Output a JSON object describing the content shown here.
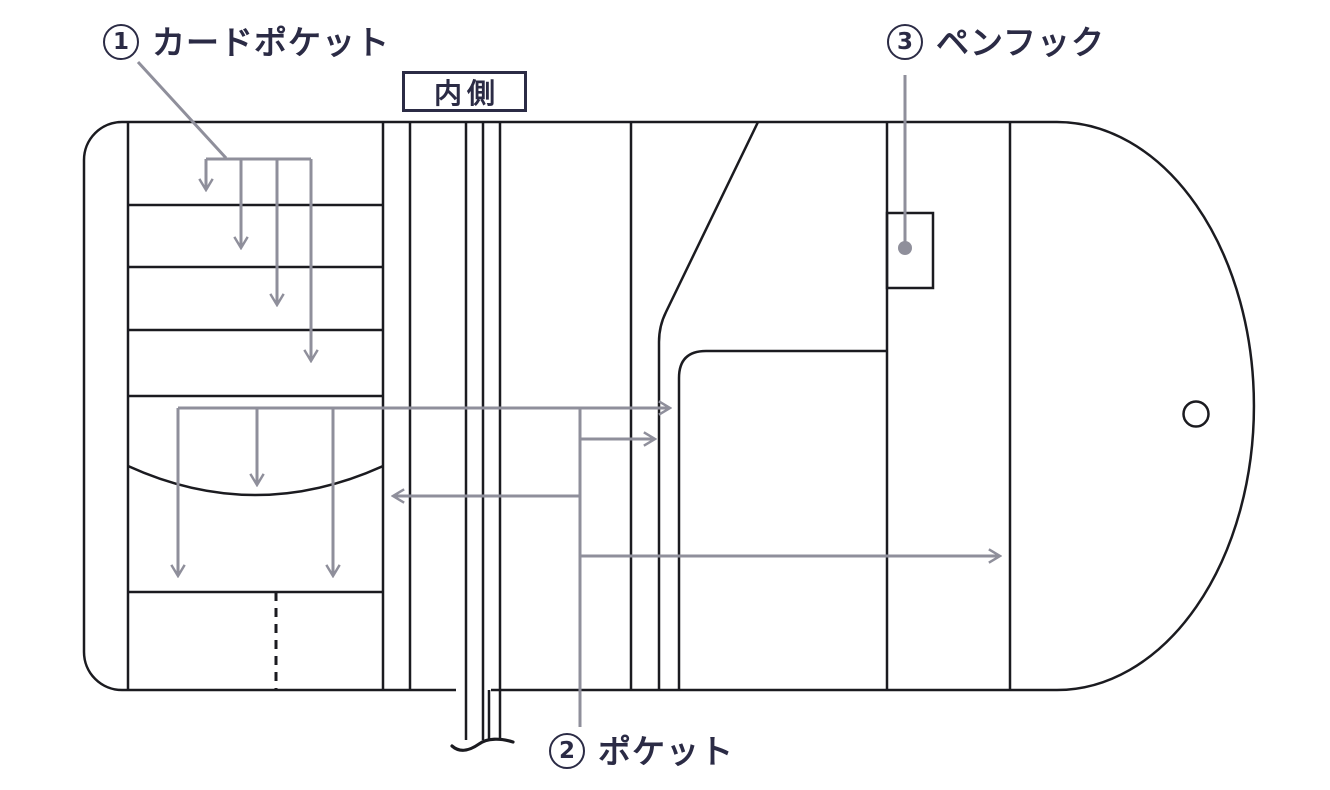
{
  "colors": {
    "background": "#ffffff",
    "line_ink": "#1b1b20",
    "annotation_gray": "#8f8f9b",
    "label_navy": "#2b2b45"
  },
  "labels": {
    "card_pocket": {
      "number": "1",
      "text": "カードポケット"
    },
    "pocket": {
      "number": "2",
      "text": "ポケット"
    },
    "pen_hook": {
      "number": "3",
      "text": "ペンフック"
    },
    "inner_side": {
      "text": "内側"
    }
  }
}
